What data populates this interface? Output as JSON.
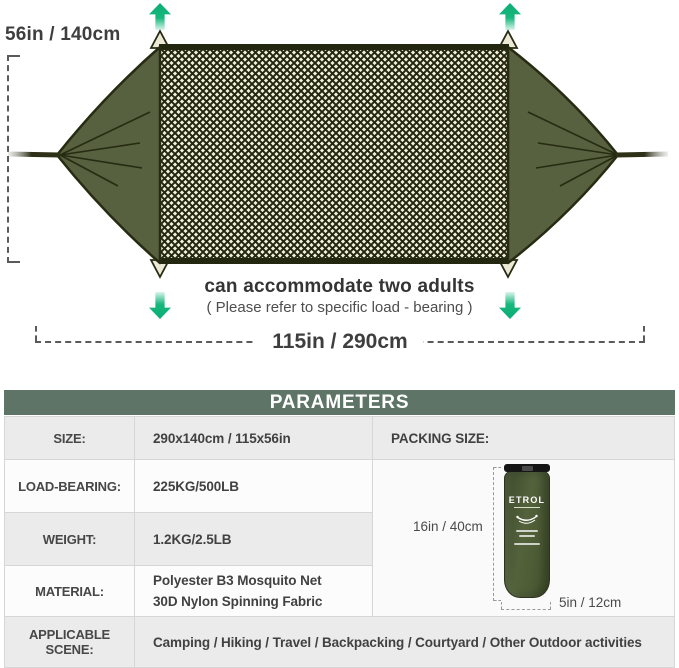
{
  "diagram": {
    "height_label": "56in / 140cm",
    "width_label": "115in / 290cm",
    "caption_title": "can accommodate two adults",
    "caption_subtitle": "( Please refer to specific load - bearing )",
    "arrow_color": "#17b77e",
    "hammock_fabric_color": "#57603f",
    "hammock_outline_color": "#23270f",
    "net_background_color": "#f3f0dc"
  },
  "parameters": {
    "header": "PARAMETERS",
    "header_bg": "#5d7466",
    "rows": [
      {
        "label": "SIZE:",
        "value": "290x140cm  /  115x56in"
      },
      {
        "label": "LOAD-BEARING:",
        "value": "225KG/500LB"
      },
      {
        "label": "WEIGHT:",
        "value": "1.2KG/2.5LB"
      },
      {
        "label": "MATERIAL:",
        "value_line1": "Polyester B3 Mosquito Net",
        "value_line2": "30D Nylon Spinning Fabric"
      },
      {
        "label": "APPLICABLE SCENE:",
        "value": "Camping / Hiking / Travel / Backpacking / Courtyard / Other Outdoor activities"
      }
    ],
    "packing": {
      "label": "PACKING SIZE:",
      "height_label": "16in / 40cm",
      "width_label": "5in / 12cm",
      "bag_brand": "ETROL"
    }
  }
}
